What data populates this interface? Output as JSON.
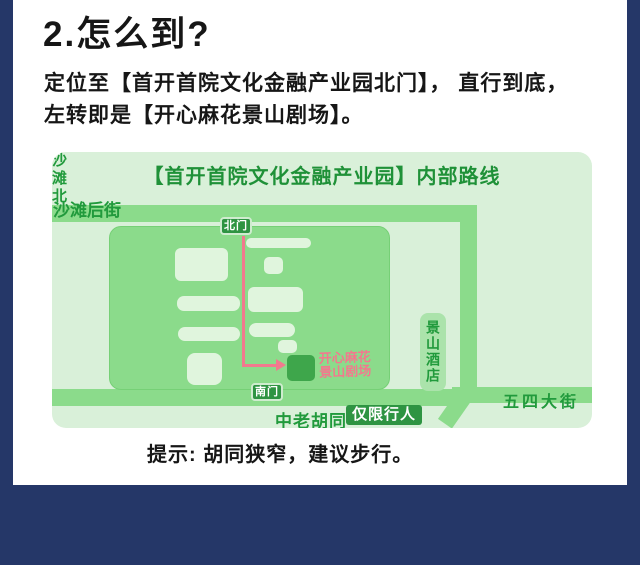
{
  "page": {
    "title": "2.怎么到?",
    "body_line1": "定位至【首开首院文化金融产业园北门】， 直行到底，",
    "body_line2": "左转即是【开心麻花景山剧场】。",
    "tip": "提示: 胡同狭窄，建议步行。"
  },
  "map": {
    "title": "【首开首院文化金融产业园】内部路线",
    "streets": {
      "shatan_back": "沙滩后街",
      "shatan_north": "沙滩北街",
      "wusi": "五四大街",
      "hutong": "中老胡同",
      "pedestrian_only": "仅限行人"
    },
    "gates": {
      "north": "北门",
      "south": "南门"
    },
    "hotel": "景山酒店",
    "theater": {
      "line1": "开心麻花",
      "line2": "景山剧场"
    }
  },
  "colors": {
    "background_navy": "#253768",
    "card_white": "#ffffff",
    "panel_green": "#d9f0d9",
    "road_green": "#8bdb8b",
    "building_green": "#e0f5dd",
    "dark_green_text": "#219a3c",
    "badge_green": "#2e9442",
    "theater_green": "#3ea64b",
    "hotel_green": "#abe3ab",
    "route_pink": "#f2798e",
    "text_black": "#161616"
  }
}
